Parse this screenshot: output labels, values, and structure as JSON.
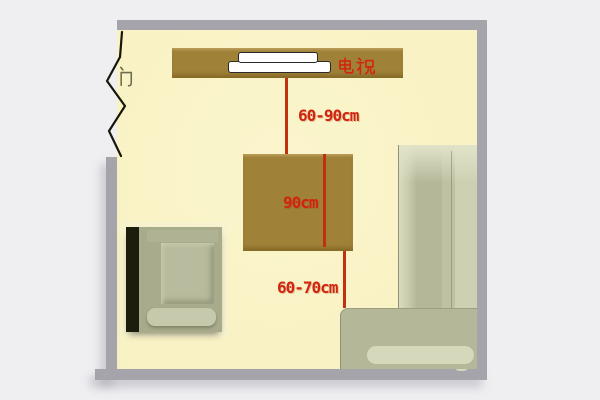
{
  "diagram": {
    "door_label": "门",
    "tv_label": "电视",
    "measurements": {
      "tv_to_table": "60-90cm",
      "table_depth": "90cm",
      "table_to_sofa": "60-70cm"
    },
    "colors": {
      "outside": "#efeef1",
      "wall": "#a5a4aa",
      "floor": "#f9f2c4",
      "wood": "#a08138",
      "measure_line": "#c2310f",
      "label_red": "#d2240e",
      "door_glyph": "#6e6e4e",
      "door_line": "#17170c",
      "sofa_sage": "#b4b798",
      "sofa_light": "#d6d8bc",
      "chair_dark": "#1c1d0d"
    }
  }
}
